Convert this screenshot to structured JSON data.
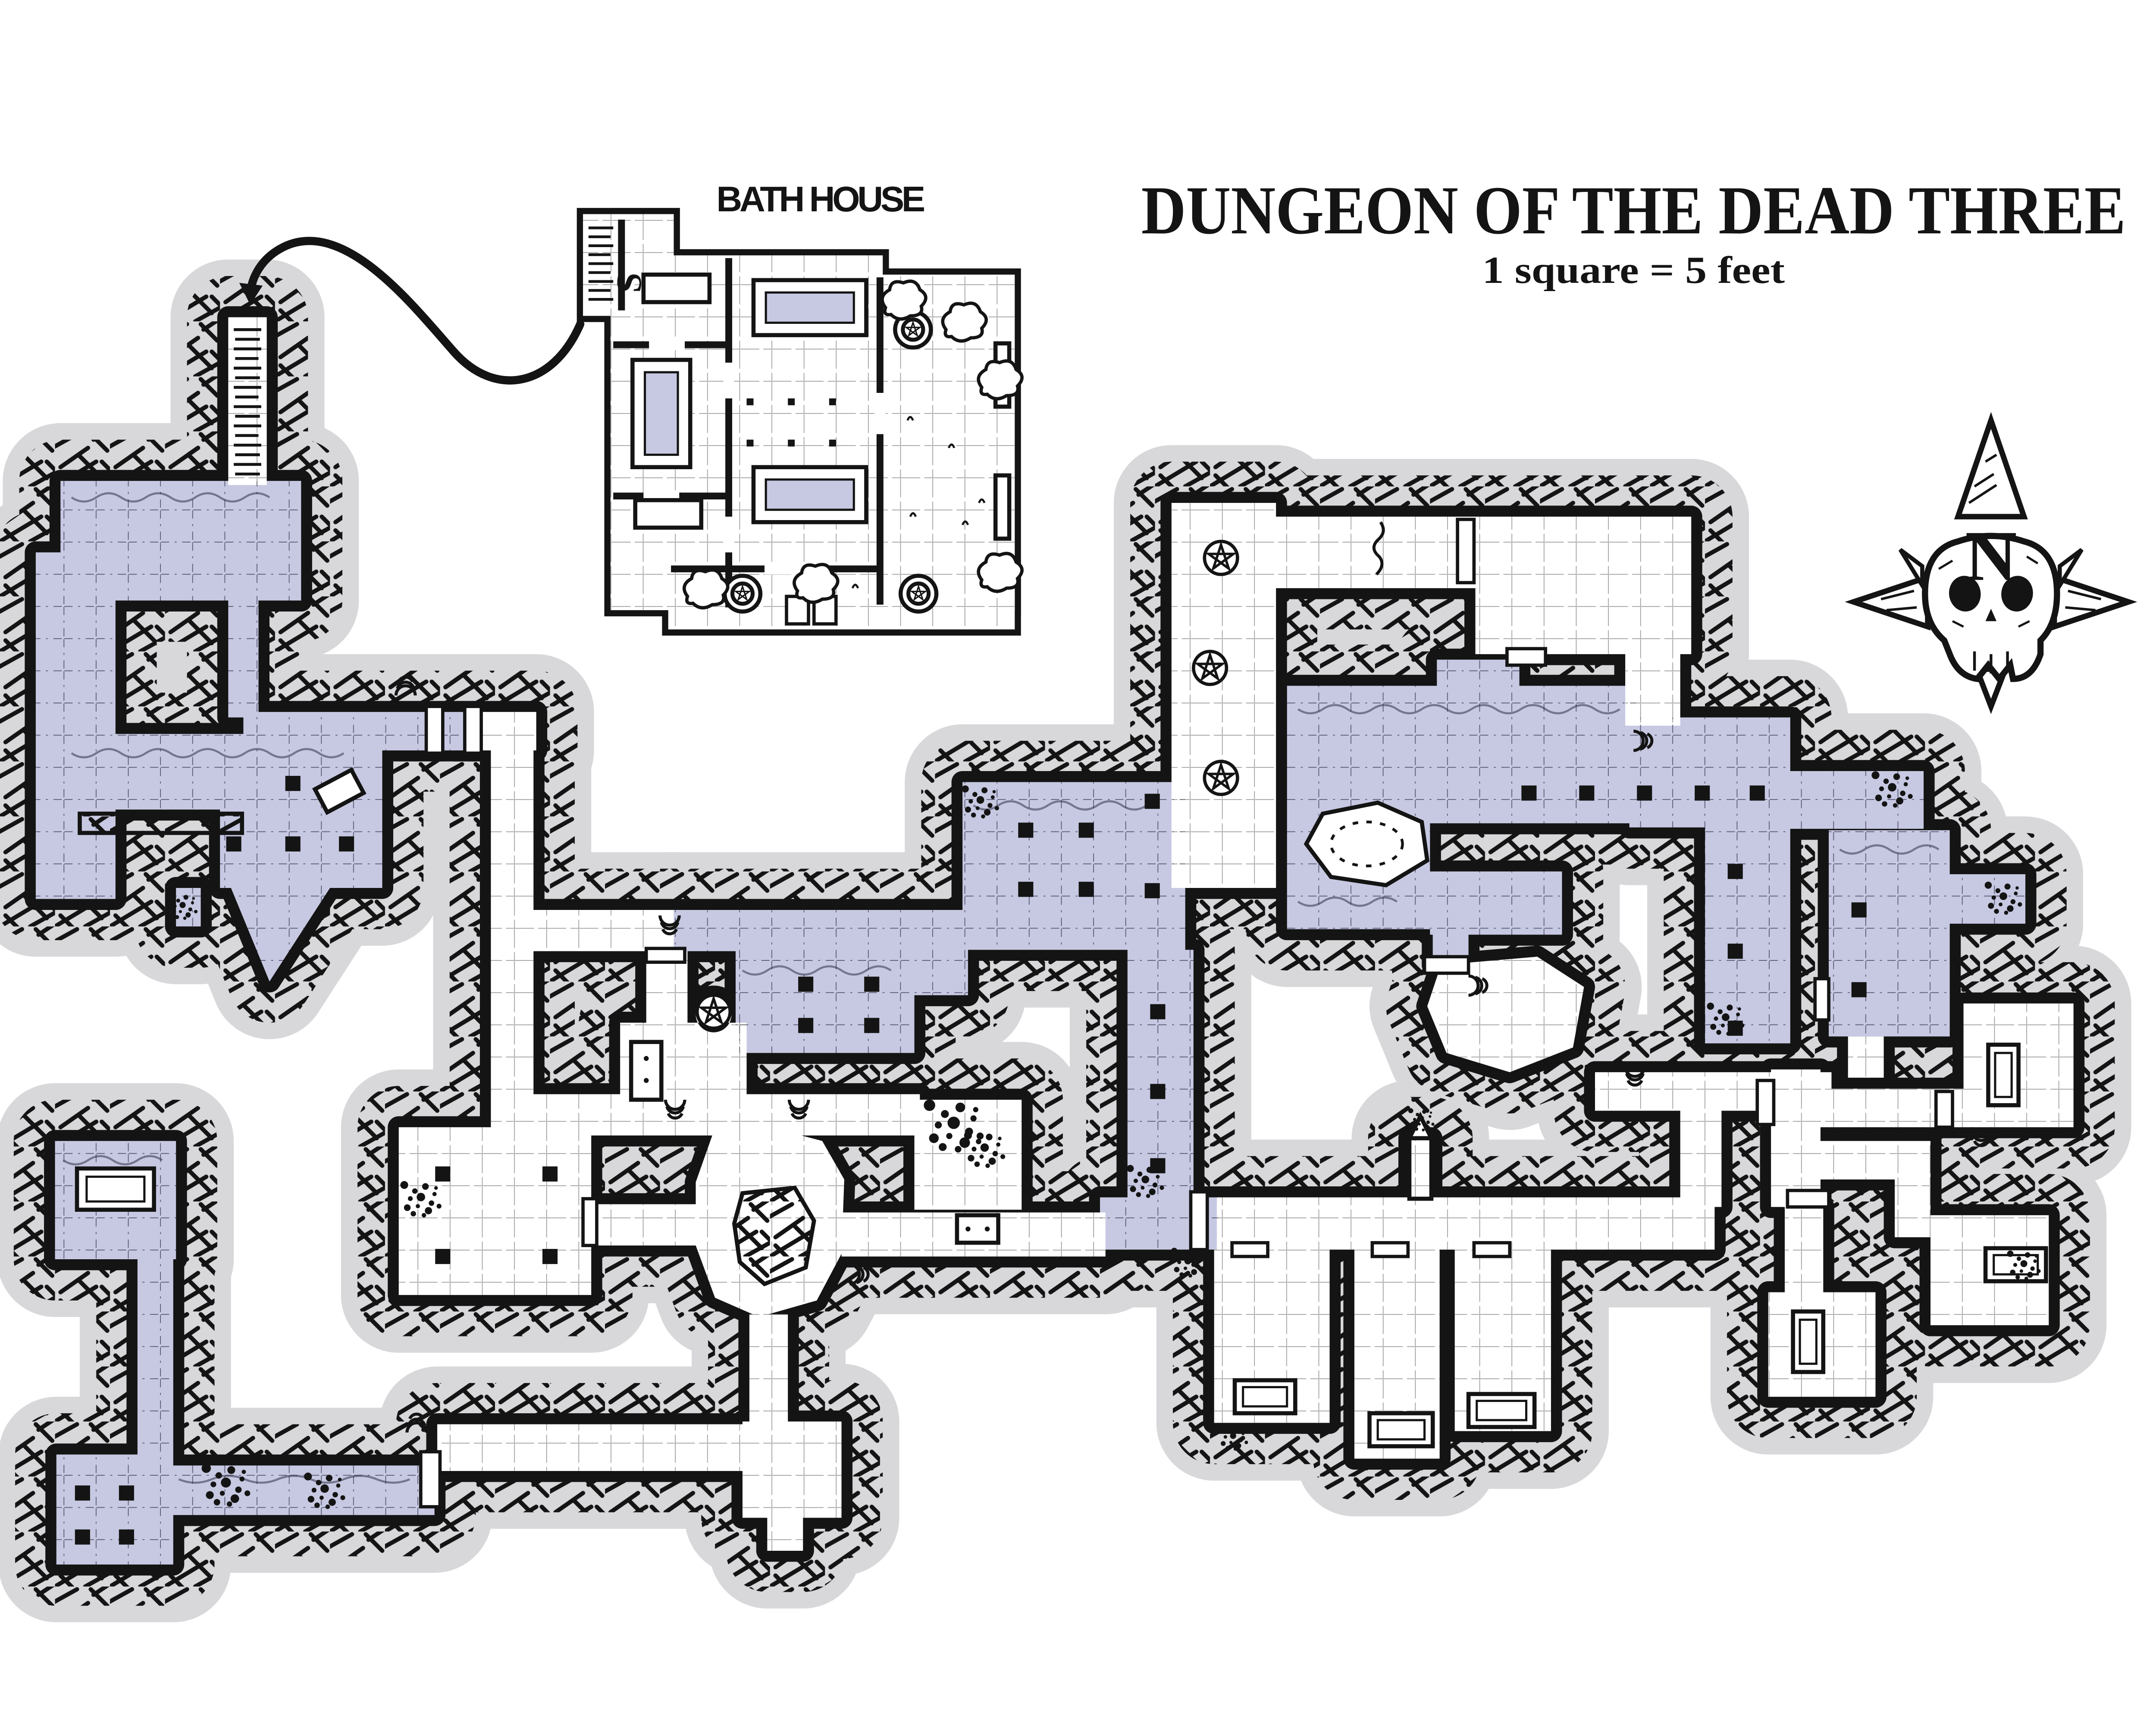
{
  "header": {
    "title": "DUNGEON OF THE DEAD THREE",
    "scale_note": "1 square = 5 feet"
  },
  "inset": {
    "label": "BATH HOUSE",
    "stair_label": "S"
  },
  "compass": {
    "north_label": "N"
  },
  "legend": {
    "square_size_feet": 5
  },
  "icons": {
    "compass": "skull-compass-rose",
    "star": "pentagram-circle",
    "door": "door-swing-arcs",
    "tub": "bathtub",
    "pillar": "stone-column",
    "stairs": "stair-rungs",
    "rubble": "rubble-speckles",
    "tree": "bush-tree",
    "pool": "round-pool"
  },
  "colors": {
    "water": "#c7c9e2",
    "rock_shadow": "#d8d8db",
    "ink": "#141414",
    "paper": "#ffffff",
    "grid_purple": "#3d3d58",
    "grid_white": "#707070"
  }
}
